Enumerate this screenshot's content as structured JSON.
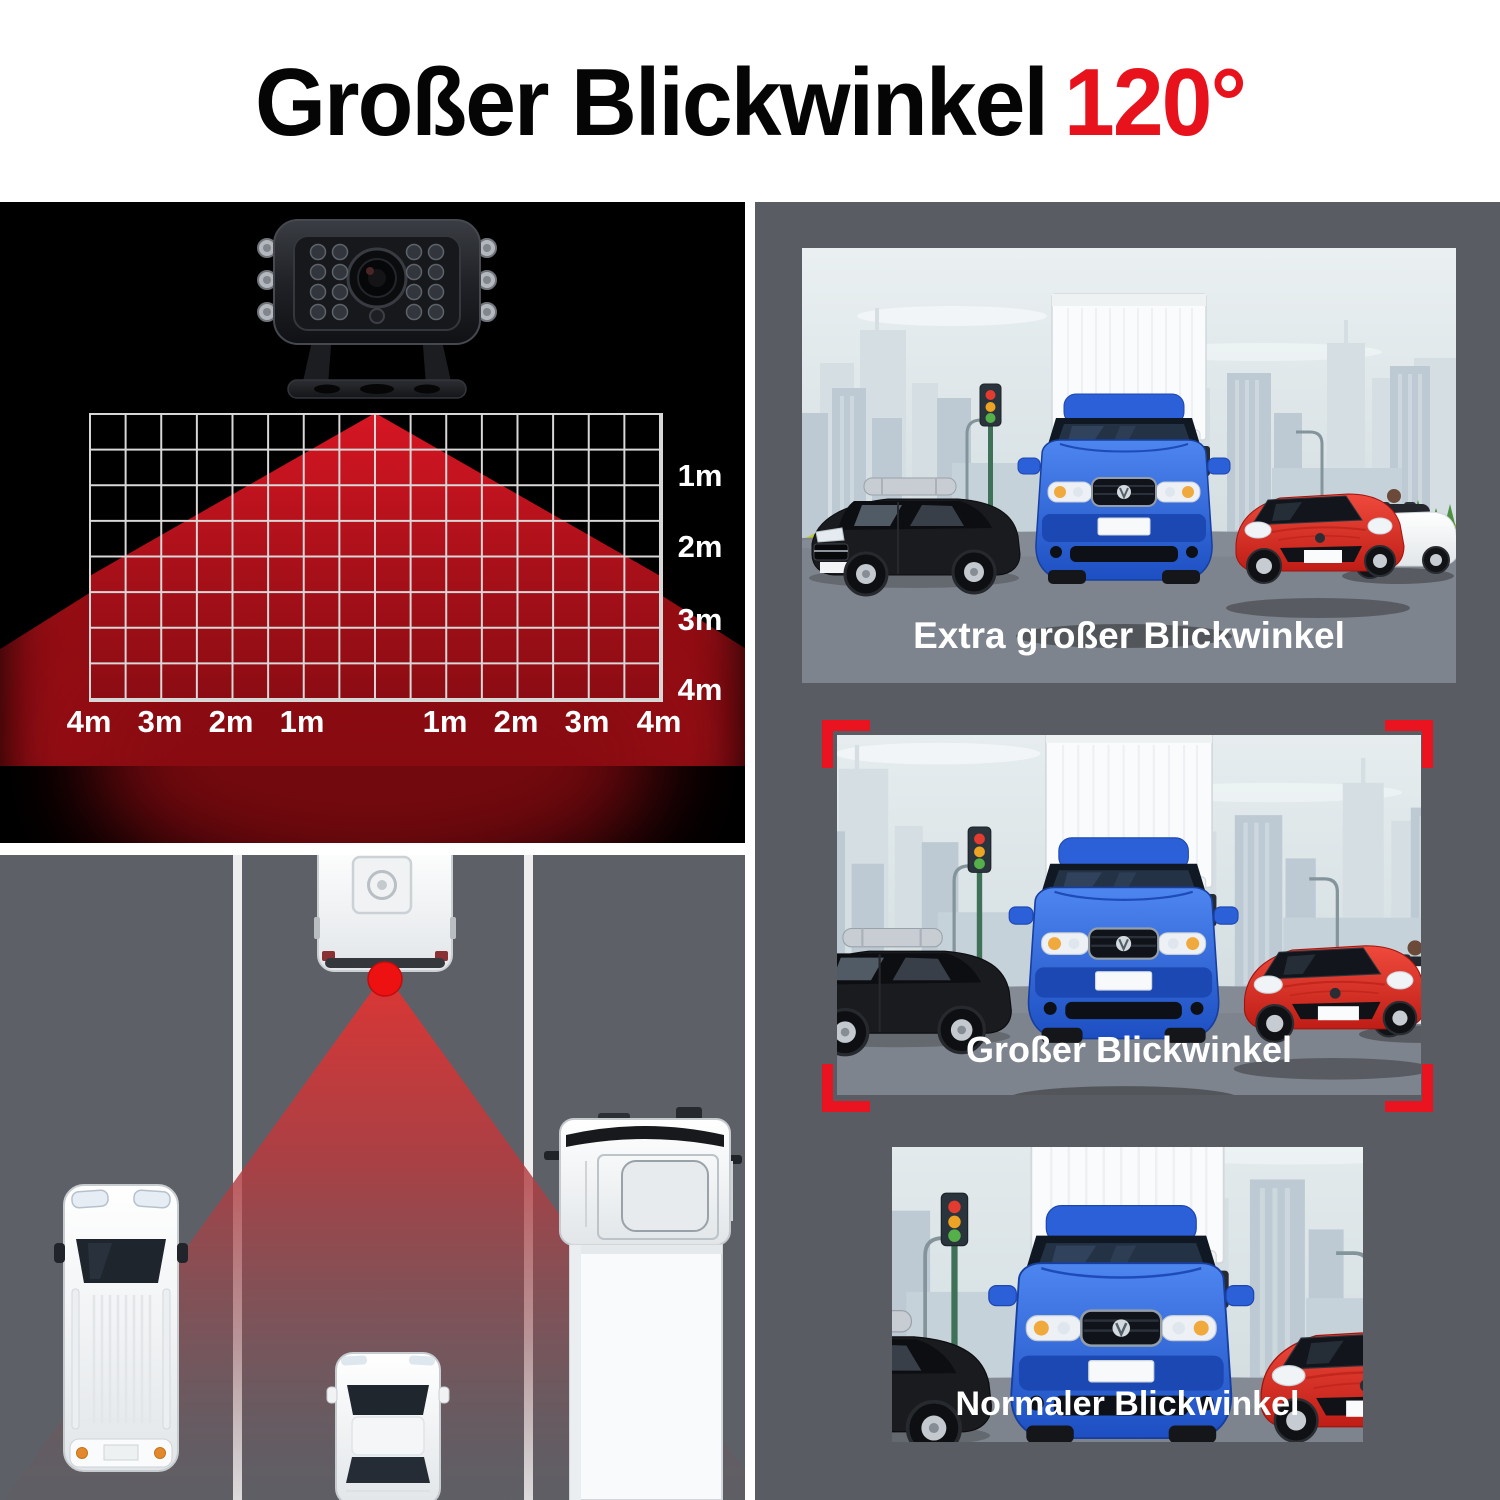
{
  "title": {
    "main": "Großer Blickwinkel",
    "accent": "120°"
  },
  "camera_range_panel": {
    "distance_labels_right": [
      "1m",
      "2m",
      "3m",
      "4m"
    ],
    "distance_labels_bottom": [
      "4m",
      "3m",
      "2m",
      "1m",
      "1m",
      "2m",
      "3m",
      "4m"
    ],
    "grid": {
      "columns": 16,
      "rows": 8
    }
  },
  "comparison_panels": [
    {
      "caption": "Extra großer Blickwinkel",
      "highlighted": false
    },
    {
      "caption": "Großer Blickwinkel",
      "highlighted": true
    },
    {
      "caption": "Normaler Blickwinkel",
      "highlighted": false
    }
  ],
  "colors": {
    "accent_red": "#e8121d",
    "bracket_red": "#ea1420",
    "cone_red_bright": "#d61623",
    "cone_red_dark": "#8c0c13",
    "camera_dot_red": "#ee1111",
    "panel_background_gray": "#595d63",
    "road_gray": "#5d6067",
    "camera_panel_black": "#000000"
  }
}
